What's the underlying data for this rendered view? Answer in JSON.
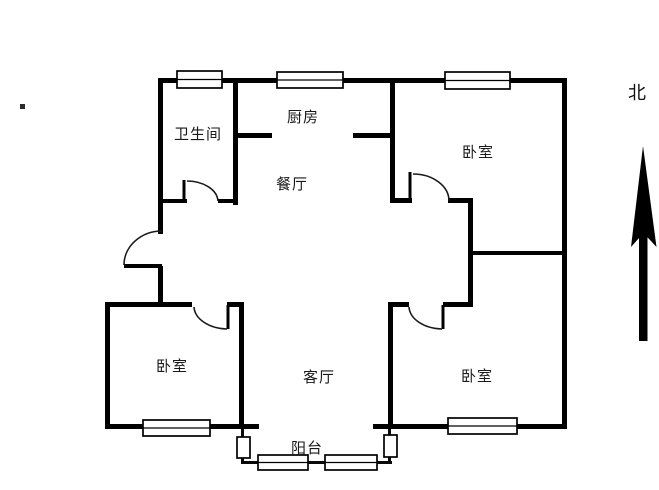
{
  "compass": {
    "label": "北"
  },
  "rooms": {
    "bathroom": {
      "label": "卫生间"
    },
    "kitchen": {
      "label": "厨房"
    },
    "dining": {
      "label": "餐厅"
    },
    "bedroom_north": {
      "label": "卧室"
    },
    "bedroom_southwest": {
      "label": "卧室"
    },
    "bedroom_southeast": {
      "label": "卧室"
    },
    "living": {
      "label": "客厅"
    },
    "balcony": {
      "label": "阳台"
    }
  },
  "colors": {
    "wall": "#000000",
    "background": "#ffffff",
    "window_fill": "#ffffff"
  }
}
